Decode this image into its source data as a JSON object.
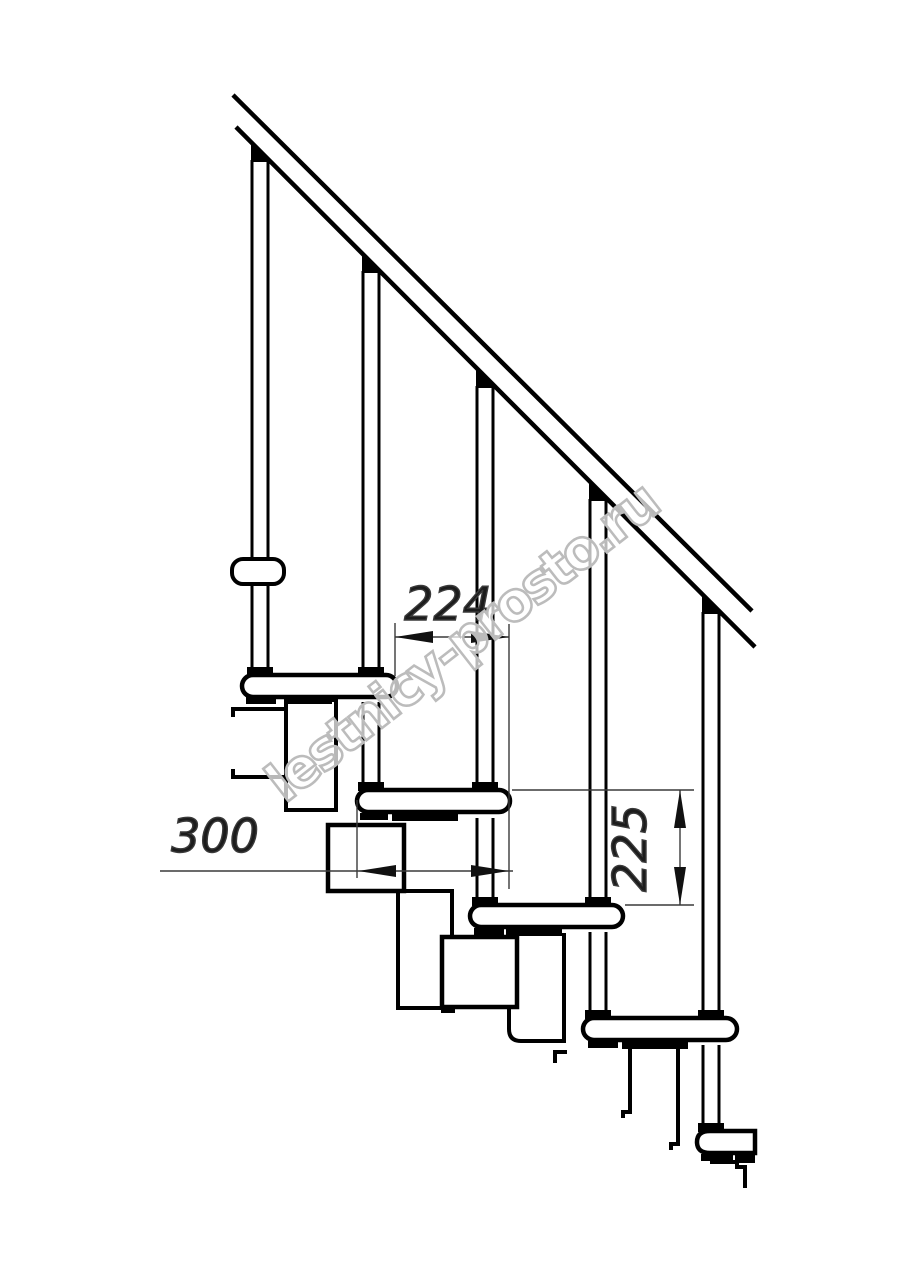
{
  "page": {
    "background_color": "#ffffff"
  },
  "drawing": {
    "type": "technical-line-drawing",
    "subject": "modular-staircase-side-elevation-with-handrail",
    "stroke_color": "#000000",
    "dimension_line_color": "#3a3a3a",
    "counts": {
      "treads": 5,
      "balusters": 5
    },
    "dimensions": [
      {
        "id": "step-run",
        "value": "224",
        "orientation": "horizontal"
      },
      {
        "id": "tread-depth",
        "value": "300",
        "orientation": "horizontal"
      },
      {
        "id": "step-rise",
        "value": "225",
        "orientation": "vertical"
      }
    ],
    "watermark": {
      "text": "lestnicy-prosto.ru",
      "color": "#bcbcbc",
      "rotation_deg": -38
    }
  }
}
